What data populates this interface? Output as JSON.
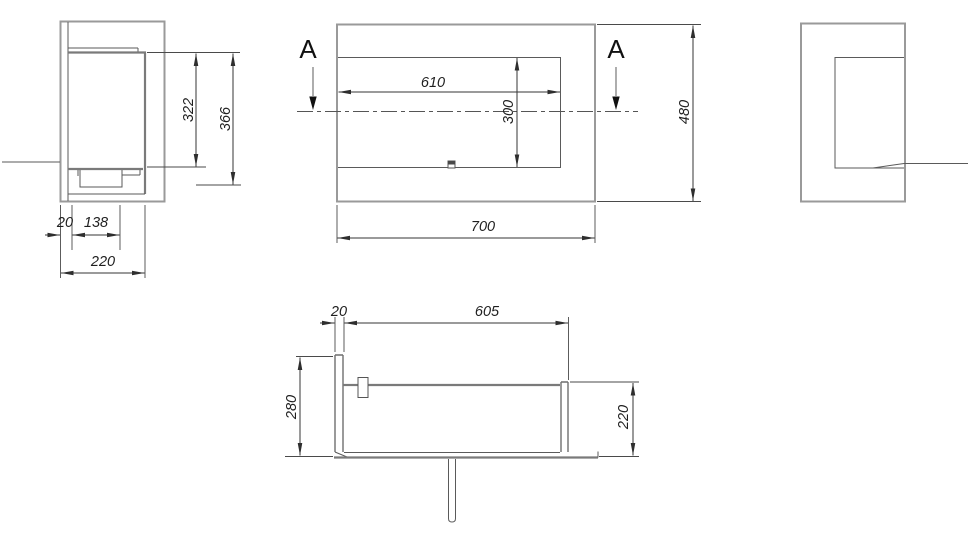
{
  "drawing": {
    "background_color": "#ffffff",
    "edge_color": "#9a9a9a",
    "dimension_line_color": "#353535",
    "text_color": "#1f1f1f",
    "views": {
      "side_left": {
        "dim_inner_height": "322",
        "dim_total_height": "366",
        "dim_wall_thickness": "20",
        "dim_tray_offset": "138",
        "dim_depth": "220"
      },
      "front": {
        "section_label": "A",
        "dim_opening_width": "610",
        "dim_opening_height": "300",
        "dim_total_width": "700",
        "dim_total_height": "480"
      },
      "section_a_a": {
        "dim_wall_thickness": "20",
        "dim_inner_length": "605",
        "dim_back_height": "280",
        "dim_front_height": "220"
      }
    }
  }
}
